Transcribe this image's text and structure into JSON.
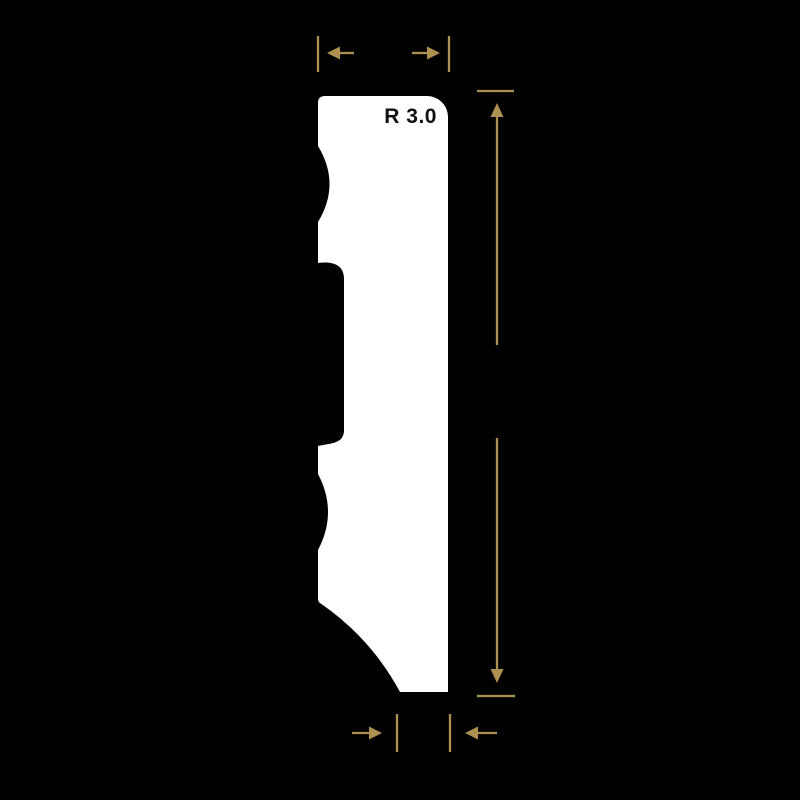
{
  "drawing": {
    "type": "moulding-profile-cross-section",
    "radius_label": "R 3.0"
  },
  "colors": {
    "background": "#000000",
    "profile-fill": "#ffffff",
    "dimension-accent": "#ae9150",
    "label-text": "#111111"
  },
  "icons": {
    "arrow-left": "◄",
    "arrow-right": "►",
    "arrow-up": "▲",
    "arrow-down": "▼"
  }
}
